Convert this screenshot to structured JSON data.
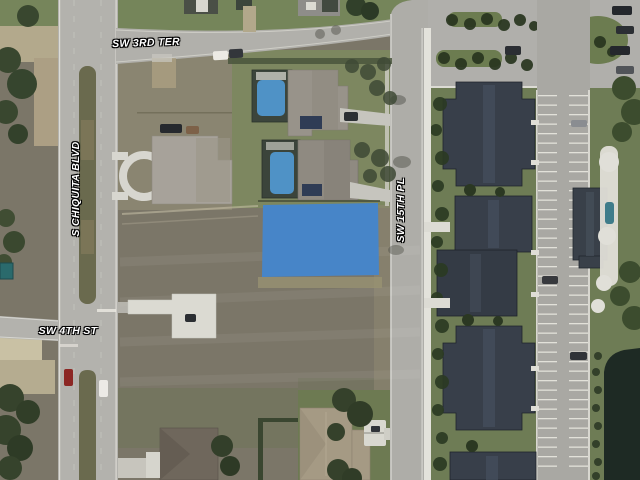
{
  "map": {
    "type": "aerial-satellite-parcel-view",
    "streets": {
      "top": "SW 3RD TER",
      "left": "S CHIQUITA BLVD",
      "right": "SW 15TH PL",
      "bottom_left": "SW 4TH ST"
    },
    "highlight": {
      "description": "selected vacant lot parcel",
      "color": "#4585cb"
    },
    "colors": {
      "road": "#b3b2ad",
      "field_grass": "#7b7668",
      "lawn_green": "#7d8760",
      "condo_roof": "#383f4a",
      "house_roof_light": "#a7a29a",
      "pool_water": "#4f92c6",
      "pond_water": "#1e2a24",
      "concrete": "#dcdbd4"
    }
  }
}
